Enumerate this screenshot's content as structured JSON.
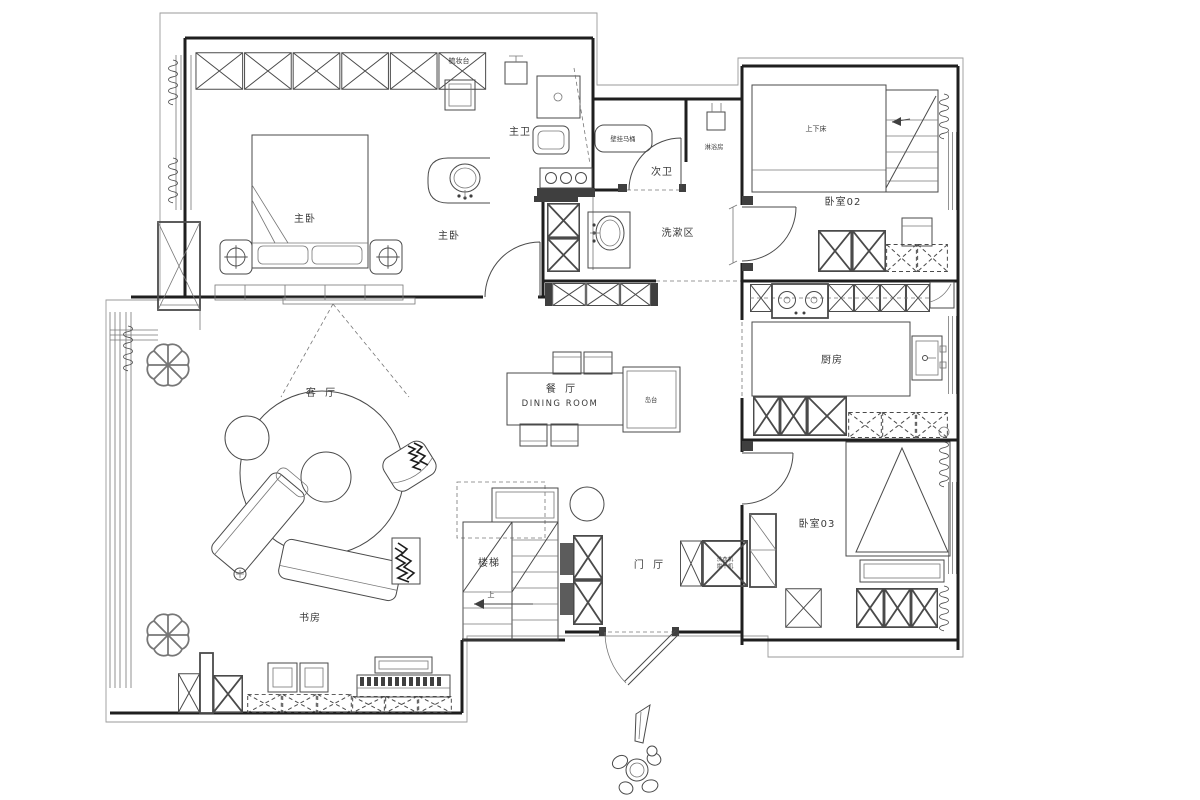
{
  "plan": {
    "rooms": [
      {
        "id": "master-bedroom",
        "label": "主卧"
      },
      {
        "id": "master-bedroom-nook",
        "label": "主卧"
      },
      {
        "id": "master-bathroom",
        "label": "主卫"
      },
      {
        "id": "second-bathroom",
        "label": "次卫"
      },
      {
        "id": "wash-area",
        "label": "洗漱区"
      },
      {
        "id": "bedroom-02",
        "label": "卧室02"
      },
      {
        "id": "kitchen",
        "label": "厨房"
      },
      {
        "id": "bedroom-03",
        "label": "卧室03"
      },
      {
        "id": "living-room",
        "label": "客 厅"
      },
      {
        "id": "dining-room-cn",
        "label": "餐 厅"
      },
      {
        "id": "dining-room-en",
        "label": "DINING ROOM"
      },
      {
        "id": "study",
        "label": "书房"
      },
      {
        "id": "stairs",
        "label": "楼梯"
      },
      {
        "id": "entry-hall",
        "label": "门 厅"
      }
    ],
    "annotations": [
      {
        "id": "dressing-table",
        "label": "梳妆台"
      },
      {
        "id": "wall-hung-toilet",
        "label": "壁挂马桶"
      },
      {
        "id": "shower-room",
        "label": "淋浴房"
      },
      {
        "id": "bunk-bed",
        "label": "上下床"
      },
      {
        "id": "island-counter",
        "label": "岛台"
      },
      {
        "id": "washing-machine",
        "label": "洗衣机"
      },
      {
        "id": "dryer",
        "label": "烘干机"
      },
      {
        "id": "stairs-up",
        "label": "上"
      }
    ],
    "colors": {
      "background": "#ffffff",
      "wall": "#1f1f1f",
      "line": "#4a4a4a",
      "label": "#3a3a3a"
    }
  }
}
